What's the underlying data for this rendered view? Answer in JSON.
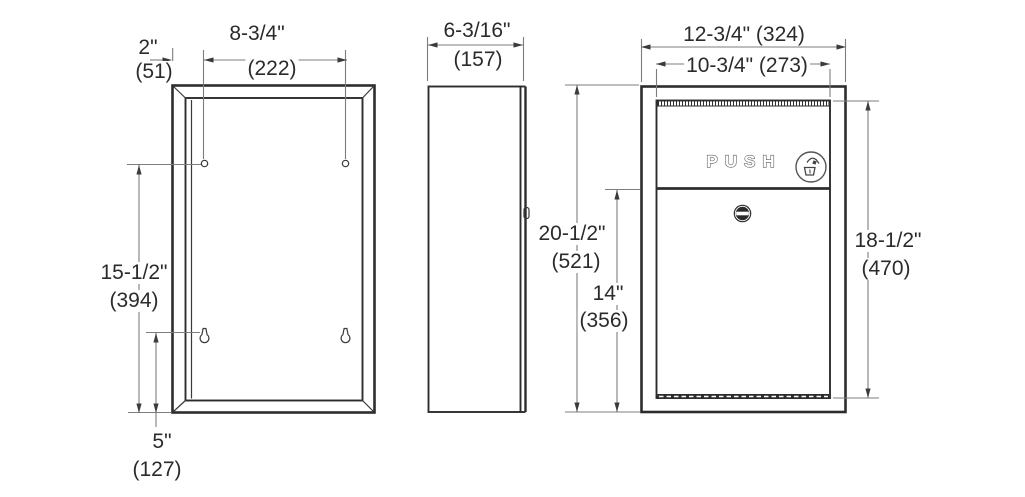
{
  "drawing_title": "",
  "push": {
    "label": "PUSH"
  },
  "dims": {
    "d2": {
      "in": "2\"",
      "mm": "(51)"
    },
    "d875": {
      "in": "8-3/4\"",
      "mm": "(222)"
    },
    "d1550": {
      "in": "15-1/2\"",
      "mm": "(394)"
    },
    "d5": {
      "in": "5\"",
      "mm": "(127)"
    },
    "d619": {
      "in": "6-3/16\"",
      "mm": "(157)"
    },
    "d2050": {
      "in": "20-1/2\"",
      "mm": "(521)"
    },
    "d14": {
      "in": "14\"",
      "mm": "(356)"
    },
    "d1275": {
      "label": "12-3/4\" (324)"
    },
    "d1075": {
      "label": "10-3/4\" (273)"
    },
    "d1850": {
      "in": "18-1/2\"",
      "mm": "(470)"
    }
  },
  "icons": {
    "dispose": "dispose-trash-icon",
    "lock": "cam-lock-icon",
    "mounting_hole": "mounting-hole-icon",
    "keyhole_slot": "keyhole-slot-icon"
  },
  "colors": {
    "object_line": "#2d2d2d",
    "dimension_line": "#7d7d7d",
    "text": "#2b2b2b",
    "background": "#ffffff"
  }
}
